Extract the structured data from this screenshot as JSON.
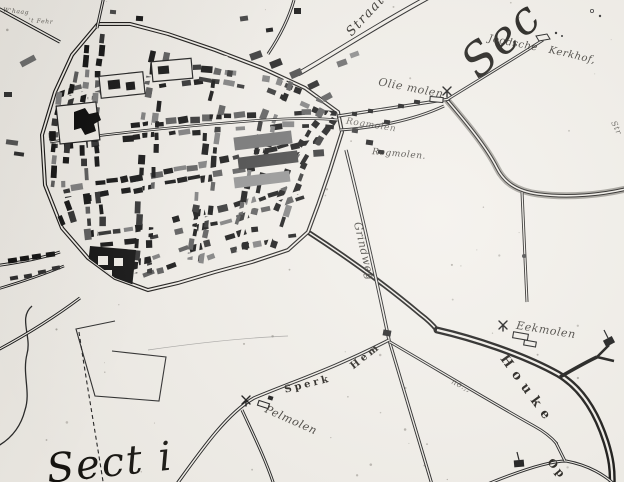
{
  "map": {
    "description": "historical engraved town map scan",
    "colors": {
      "paper": "#f2efe9",
      "ink": "#161412",
      "shade": "#8b8881"
    },
    "labels": [
      {
        "id": "section-top-right",
        "text": "Sec",
        "x": 501,
        "y": 39,
        "rot": -42,
        "size": 45,
        "style": "display"
      },
      {
        "id": "section-bottom-left",
        "text": "Sect i",
        "x": 110,
        "y": 463,
        "rot": -6,
        "size": 40,
        "style": "display"
      },
      {
        "id": "joodsche",
        "text": "Joodsche",
        "x": 513,
        "y": 44,
        "rot": 11,
        "size": 10,
        "style": "script"
      },
      {
        "id": "kerkhof",
        "text": "Kerkhof,",
        "x": 572,
        "y": 56,
        "rot": 13,
        "size": 10,
        "style": "script"
      },
      {
        "id": "olie-molen",
        "text": "Olie molen",
        "x": 411,
        "y": 88,
        "rot": 11,
        "size": 11,
        "style": "script"
      },
      {
        "id": "rogmolen-1",
        "text": "Rogmolen",
        "x": 371,
        "y": 126,
        "rot": 9,
        "size": 9,
        "style": "script faded"
      },
      {
        "id": "rogmolen-2",
        "text": "Rogmolen.",
        "x": 399,
        "y": 155,
        "rot": 5,
        "size": 9,
        "style": "script"
      },
      {
        "id": "straat",
        "text": "Straat",
        "x": 366,
        "y": 16,
        "rot": -47,
        "size": 13,
        "style": "italic"
      },
      {
        "id": "grindweg",
        "text": "Grindweg",
        "x": 364,
        "y": 251,
        "rot": 77,
        "size": 11,
        "style": "script"
      },
      {
        "id": "sperk",
        "text": "Sperk",
        "x": 308,
        "y": 385,
        "rot": -14,
        "size": 10,
        "style": "caps"
      },
      {
        "id": "hem",
        "text": "Hem",
        "x": 366,
        "y": 357,
        "rot": -38,
        "size": 10,
        "style": "caps"
      },
      {
        "id": "pelmolen",
        "text": "Pelmolen",
        "x": 291,
        "y": 420,
        "rot": 24,
        "size": 11,
        "style": "script"
      },
      {
        "id": "eekmolen",
        "text": "Eekmolen",
        "x": 546,
        "y": 330,
        "rot": 9,
        "size": 11,
        "style": "script"
      },
      {
        "id": "houke",
        "text": "Houke",
        "x": 527,
        "y": 390,
        "rot": 54,
        "size": 13,
        "style": "caps-wide"
      },
      {
        "id": "op",
        "text": "Op",
        "x": 557,
        "y": 469,
        "rot": 50,
        "size": 11,
        "style": "caps"
      },
      {
        "id": "no-note",
        "text": "no.,,",
        "x": 461,
        "y": 386,
        "rot": 26,
        "size": 8,
        "style": "script faded"
      },
      {
        "id": "edge-note",
        "text": "Str",
        "x": 616,
        "y": 128,
        "rot": 64,
        "size": 8,
        "style": "script faded"
      },
      {
        "id": "tiny-note-1",
        "text": "W'haag",
        "x": 16,
        "y": 12,
        "rot": 6,
        "size": 6,
        "style": "script faded"
      },
      {
        "id": "tiny-note-2",
        "text": "'t Fehr",
        "x": 41,
        "y": 22,
        "rot": 4,
        "size": 6,
        "style": "script faded"
      }
    ],
    "symbols": [
      {
        "type": "mill",
        "name": "olie-molen-mill-icon",
        "x": 447,
        "y": 92
      },
      {
        "type": "mill",
        "name": "eekmolen-mill-icon",
        "x": 503,
        "y": 326
      },
      {
        "type": "mill",
        "name": "pelmolen-mill-icon",
        "x": 246,
        "y": 401
      },
      {
        "type": "cemetery",
        "name": "joodsche-kerkhof-icon",
        "x": 542,
        "y": 38
      }
    ]
  }
}
